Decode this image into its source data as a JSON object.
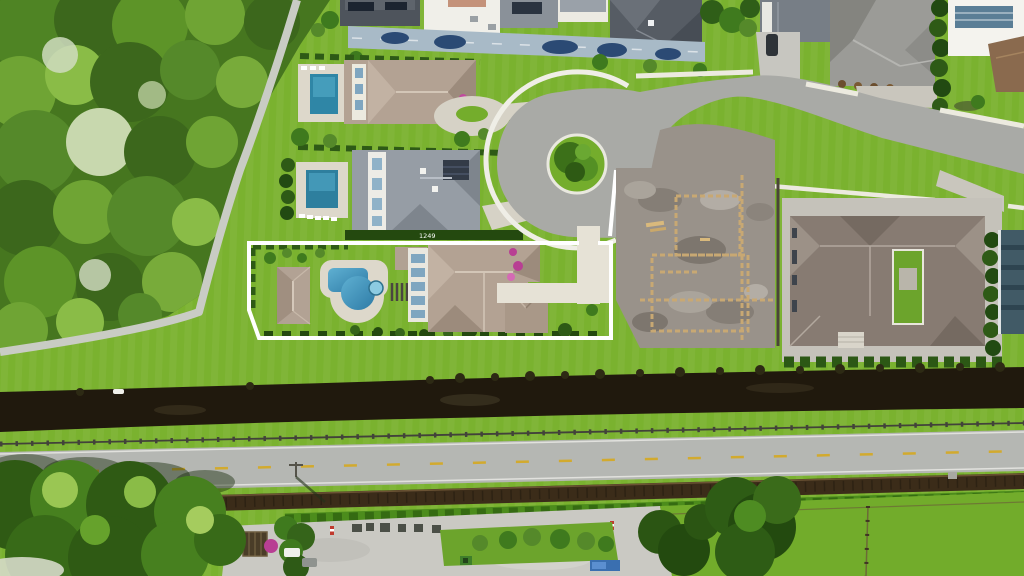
{
  "labels": {
    "house_number": "1249"
  },
  "palette": {
    "grass_base": "#7ab22f",
    "grass_field": "#72ac2b",
    "forest_base": "#46761f",
    "path_gray": "#c9ccc4",
    "asphalt": "#a9aaa6",
    "road_gray": "#b5b7b3",
    "sidewalk_white": "#efeee6",
    "outline_white": "#ffffff",
    "roof_tan": "#b3a293",
    "roof_gray": "#969da5",
    "roof_right": "#877b72",
    "roof_teal": "#415a66",
    "pool_blue": "#3a8cb4",
    "deck_white": "#ddd8cb",
    "paver_light": "#d6d2c6",
    "driveway_blue": "#a8bac7",
    "dirt_gray": "#99928a",
    "sand_tan": "#c8a873",
    "canal_dark": "#20190d",
    "berm_brown": "#3b2c19",
    "hedge_dark": "#2e5a16",
    "yellow_line": "#d2aa2e",
    "parking_gray": "#cac9c3",
    "magenta_flowers": "#b83f93"
  }
}
